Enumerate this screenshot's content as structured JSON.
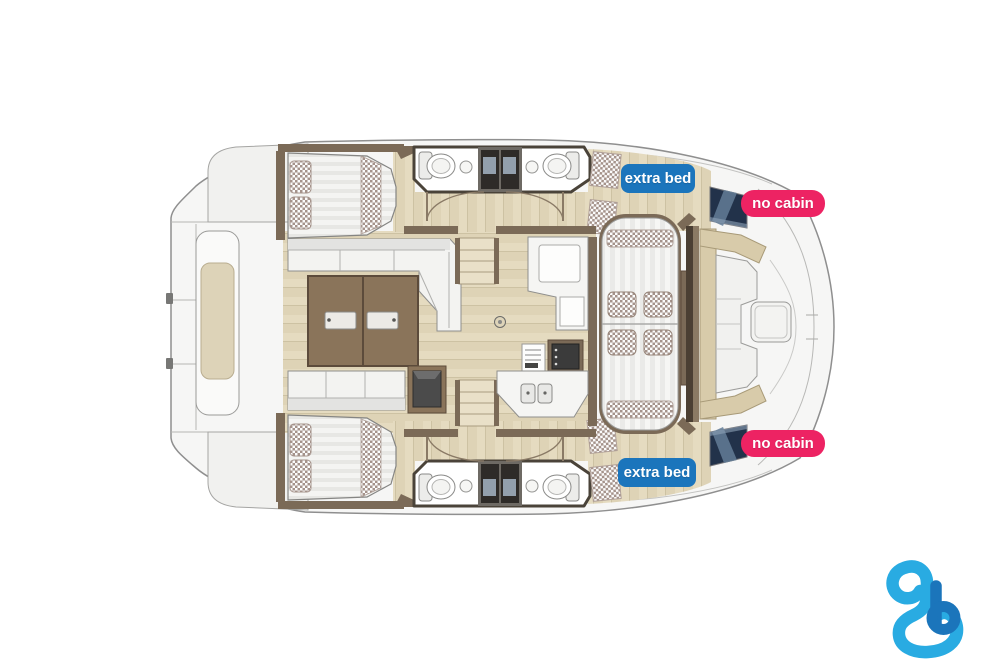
{
  "plan": {
    "type": "catamaran-deck-floorplan",
    "badges": {
      "extra_bed_top": {
        "label": "extra bed",
        "color": "#1b75bc"
      },
      "no_cabin_top": {
        "label": "no cabin",
        "color": "#ed2363"
      },
      "no_cabin_bottom": {
        "label": "no cabin",
        "color": "#ed2363"
      },
      "extra_bed_bottom": {
        "label": "extra bed",
        "color": "#1b75bc"
      }
    },
    "palette": {
      "hull_fill": "#f6f6f5",
      "wood_floor": "#e5dbc0",
      "wall_brown": "#7b6a57",
      "table_brown": "#8a745a",
      "window_dark": "#22324a",
      "bench_beige": "#d8cbaa",
      "checker_fabric": "#a5938b"
    }
  },
  "logo": {
    "name": "boataround-b-logo",
    "light_blue": "#29abe2",
    "dark_blue": "#1b75bb"
  }
}
